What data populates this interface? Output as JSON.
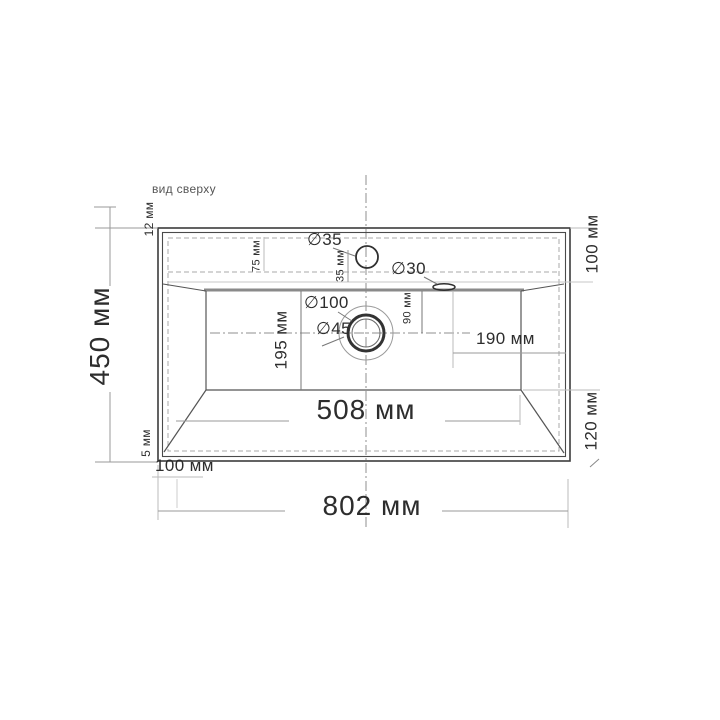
{
  "view_label": "вид сверху",
  "units": "мм",
  "labels": {
    "overall_width": "802 мм",
    "overall_depth": "450 мм",
    "basin_bottom_width": "508 мм",
    "basin_bottom_depth": "195 мм",
    "drain_to_right_edge": "190 мм",
    "deck_depth_right": "100 мм",
    "front_depth_right": "120 мм",
    "bottom_left_offset": "100 мм",
    "top_rim": "12 мм",
    "bottom_rim": "5 мм",
    "faucet_back_offset": "75 мм",
    "faucet_center_offset": "35 мм",
    "drain_back_offset": "90 мм",
    "faucet_hole_dia": "∅35",
    "overflow_hole_dia": "∅30",
    "drain_outer_dia": "∅100",
    "drain_hole_dia": "∅45"
  },
  "colors": {
    "line_dark": "#3c3c3c",
    "line_mid": "#8a8a8a",
    "line_light": "#bbbbbb",
    "text": "#2d2d2d"
  }
}
